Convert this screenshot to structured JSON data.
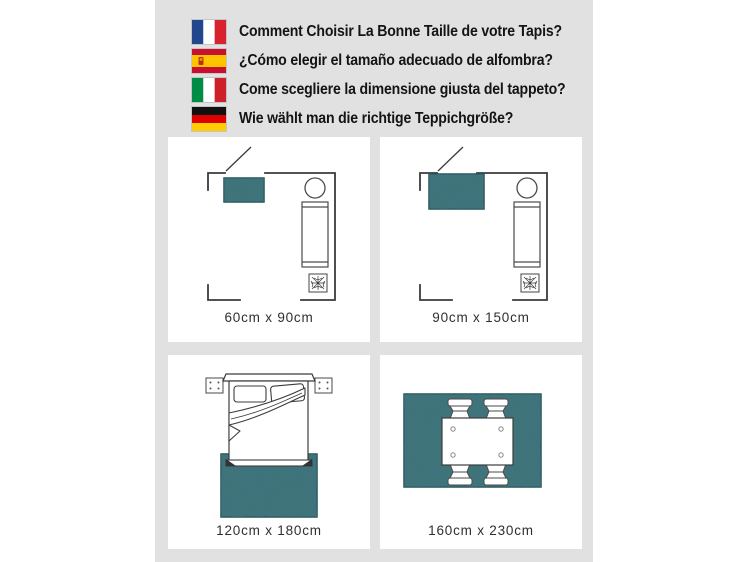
{
  "header": {
    "items": [
      {
        "flag": "france-flag-icon",
        "text": "Comment Choisir La Bonne Taille de votre Tapis?"
      },
      {
        "flag": "spain-flag-icon",
        "text": "¿Cómo elegir el tamaño adecuado de alfombra?"
      },
      {
        "flag": "italy-flag-icon",
        "text": "Come scegliere la dimensione giusta del tappeto?"
      },
      {
        "flag": "germany-flag-icon",
        "text": "Wie wählt man die richtige Teppichgröße?"
      }
    ]
  },
  "panels": [
    {
      "id": "room-floorplan-small-rug",
      "illustration": "floorplan with door, round table, sofa, plant and small rug",
      "label": "60cm x 90cm"
    },
    {
      "id": "room-floorplan-large-rug",
      "illustration": "floorplan with door, round table, sofa, plant and large rug",
      "label": "90cm x 150cm"
    },
    {
      "id": "bedroom-rug",
      "illustration": "double bed with pillows, folded duvet, nightstands, rug at foot of bed",
      "label": "120cm x 180cm"
    },
    {
      "id": "dining-table-rug",
      "illustration": "dining table with four chairs fully on rug",
      "label": "160cm x 230cm"
    }
  ],
  "colors": {
    "backdrop": "#e1e1e1",
    "panel_bg": "#ffffff",
    "wall_line": "#3b3b3b",
    "rug_base": "#3f747d",
    "rug_edge": "#24525a",
    "header_text": "#141414",
    "label_text": "#2f2f2f"
  }
}
